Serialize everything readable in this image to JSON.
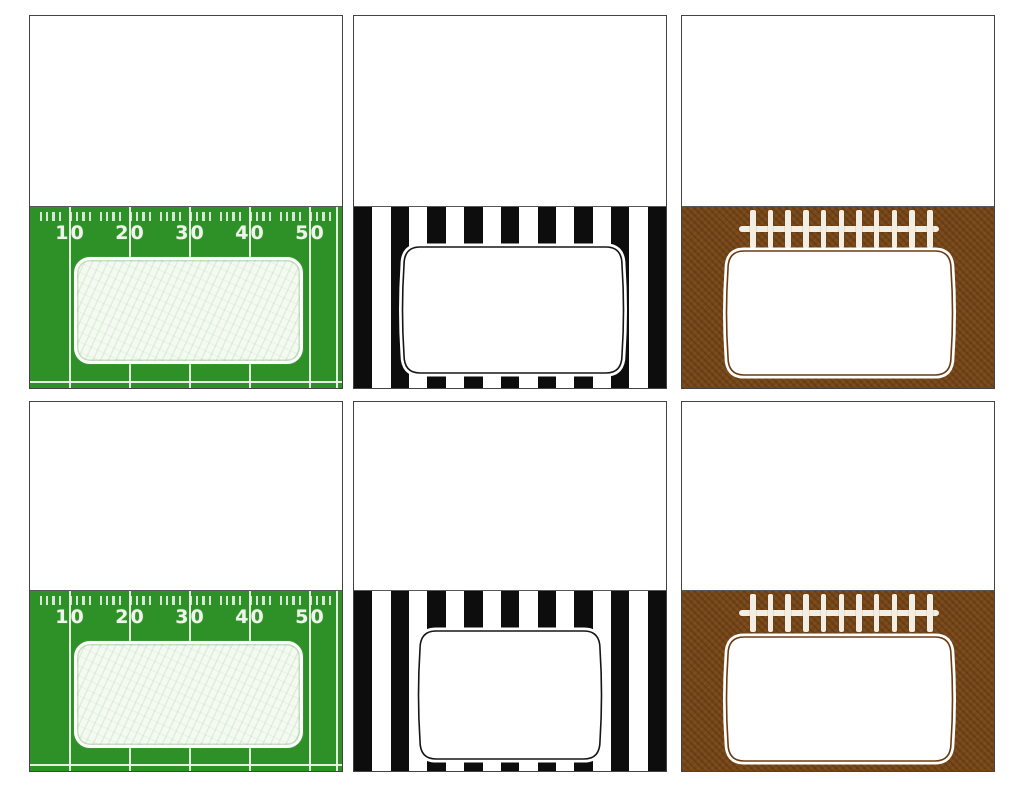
{
  "sheet": {
    "background": "#ffffff",
    "rows": 2,
    "cols": 3,
    "description": "Printable football party fold-over tent place cards, blank top fold and themed front"
  },
  "colors": {
    "card_border": "#434343",
    "fold_line": "#585858",
    "card_top_bg": "#ffffff",
    "field_green": "#2e9128",
    "field_markings": "#eef4ea",
    "field_label_fill": "#f4f9f1",
    "field_label_border": "#fdfefc",
    "stripe_black": "#0d0d0d",
    "stripe_white": "#ffffff",
    "frame_fill": "#ffffff",
    "referee_frame_stroke": "#161616",
    "football_brown": "#764719",
    "football_frame_stroke": "#6a3b12",
    "laces_white": "#f2eee3"
  },
  "cards": [
    {
      "theme": "field",
      "row": 1,
      "col": 1,
      "label_text": ""
    },
    {
      "theme": "referee",
      "row": 1,
      "col": 2,
      "label_text": ""
    },
    {
      "theme": "football",
      "row": 1,
      "col": 3,
      "label_text": ""
    },
    {
      "theme": "field",
      "row": 2,
      "col": 1,
      "label_text": ""
    },
    {
      "theme": "referee",
      "row": 2,
      "col": 2,
      "label_text": ""
    },
    {
      "theme": "football",
      "row": 2,
      "col": 3,
      "label_text": ""
    }
  ],
  "field": {
    "yard_numbers": [
      "10",
      "20",
      "30",
      "40",
      "50"
    ],
    "yard_line_count": 5,
    "tick_groups": 10,
    "ticks_per_group": 4
  },
  "referee": {
    "stripe_count": 17
  },
  "football": {
    "stitch_count": 11
  }
}
